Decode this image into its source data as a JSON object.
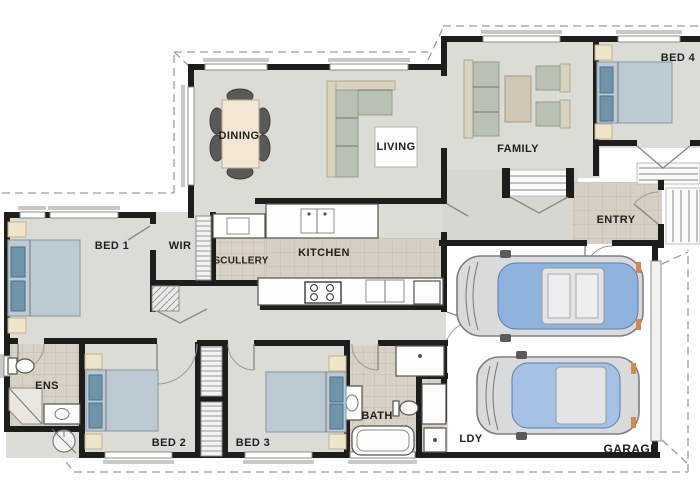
{
  "plan": {
    "kind": "residential-floor-plan",
    "rooms": [
      {
        "id": "dining",
        "label": "DINING"
      },
      {
        "id": "living",
        "label": "LIVING"
      },
      {
        "id": "family",
        "label": "FAMILY"
      },
      {
        "id": "bed4",
        "label": "BED 4"
      },
      {
        "id": "entry",
        "label": "ENTRY"
      },
      {
        "id": "bed1",
        "label": "BED 1"
      },
      {
        "id": "wir",
        "label": "WIR"
      },
      {
        "id": "scullery",
        "label": "SCULLERY"
      },
      {
        "id": "kitchen",
        "label": "KITCHEN"
      },
      {
        "id": "ens",
        "label": "ENS"
      },
      {
        "id": "bed2",
        "label": "BED 2"
      },
      {
        "id": "bed3",
        "label": "BED 3"
      },
      {
        "id": "bath",
        "label": "BATH"
      },
      {
        "id": "ldy",
        "label": "LDY"
      },
      {
        "id": "garage",
        "label": "GARAGE"
      }
    ],
    "fixtures": [
      "dining-table-with-six-chairs",
      "l-shaped-sofa",
      "family-sofa",
      "two-armchairs",
      "coffee-table",
      "double-bed-x4",
      "bedside-tables",
      "walk-in-robe-shelving",
      "wardrobe-shelving",
      "kitchen-island-with-sink",
      "kitchen-bench",
      "cooktop",
      "scullery-bench",
      "fridge",
      "bathtub",
      "shower-x2",
      "toilet-x2",
      "vanity-x2",
      "laundry-tub",
      "car-top-view-x2",
      "double-garage-door",
      "porch-steps-x3",
      "french-doors-x2",
      "site-circle-symbol"
    ],
    "colors": {
      "wall": "#1d1d1b",
      "floor": "#dcdcd7",
      "tile": "#d6cfc3",
      "garage_floor": "#ffffff",
      "bed_duvet": "#bccbd3",
      "pillow": "#6f93a8",
      "bedside_cream": "#efe5c8",
      "sofa_sage": "#b8c1b2",
      "car_glass": "#8fb3dd",
      "roof_dashed": "#9c9c98"
    }
  }
}
